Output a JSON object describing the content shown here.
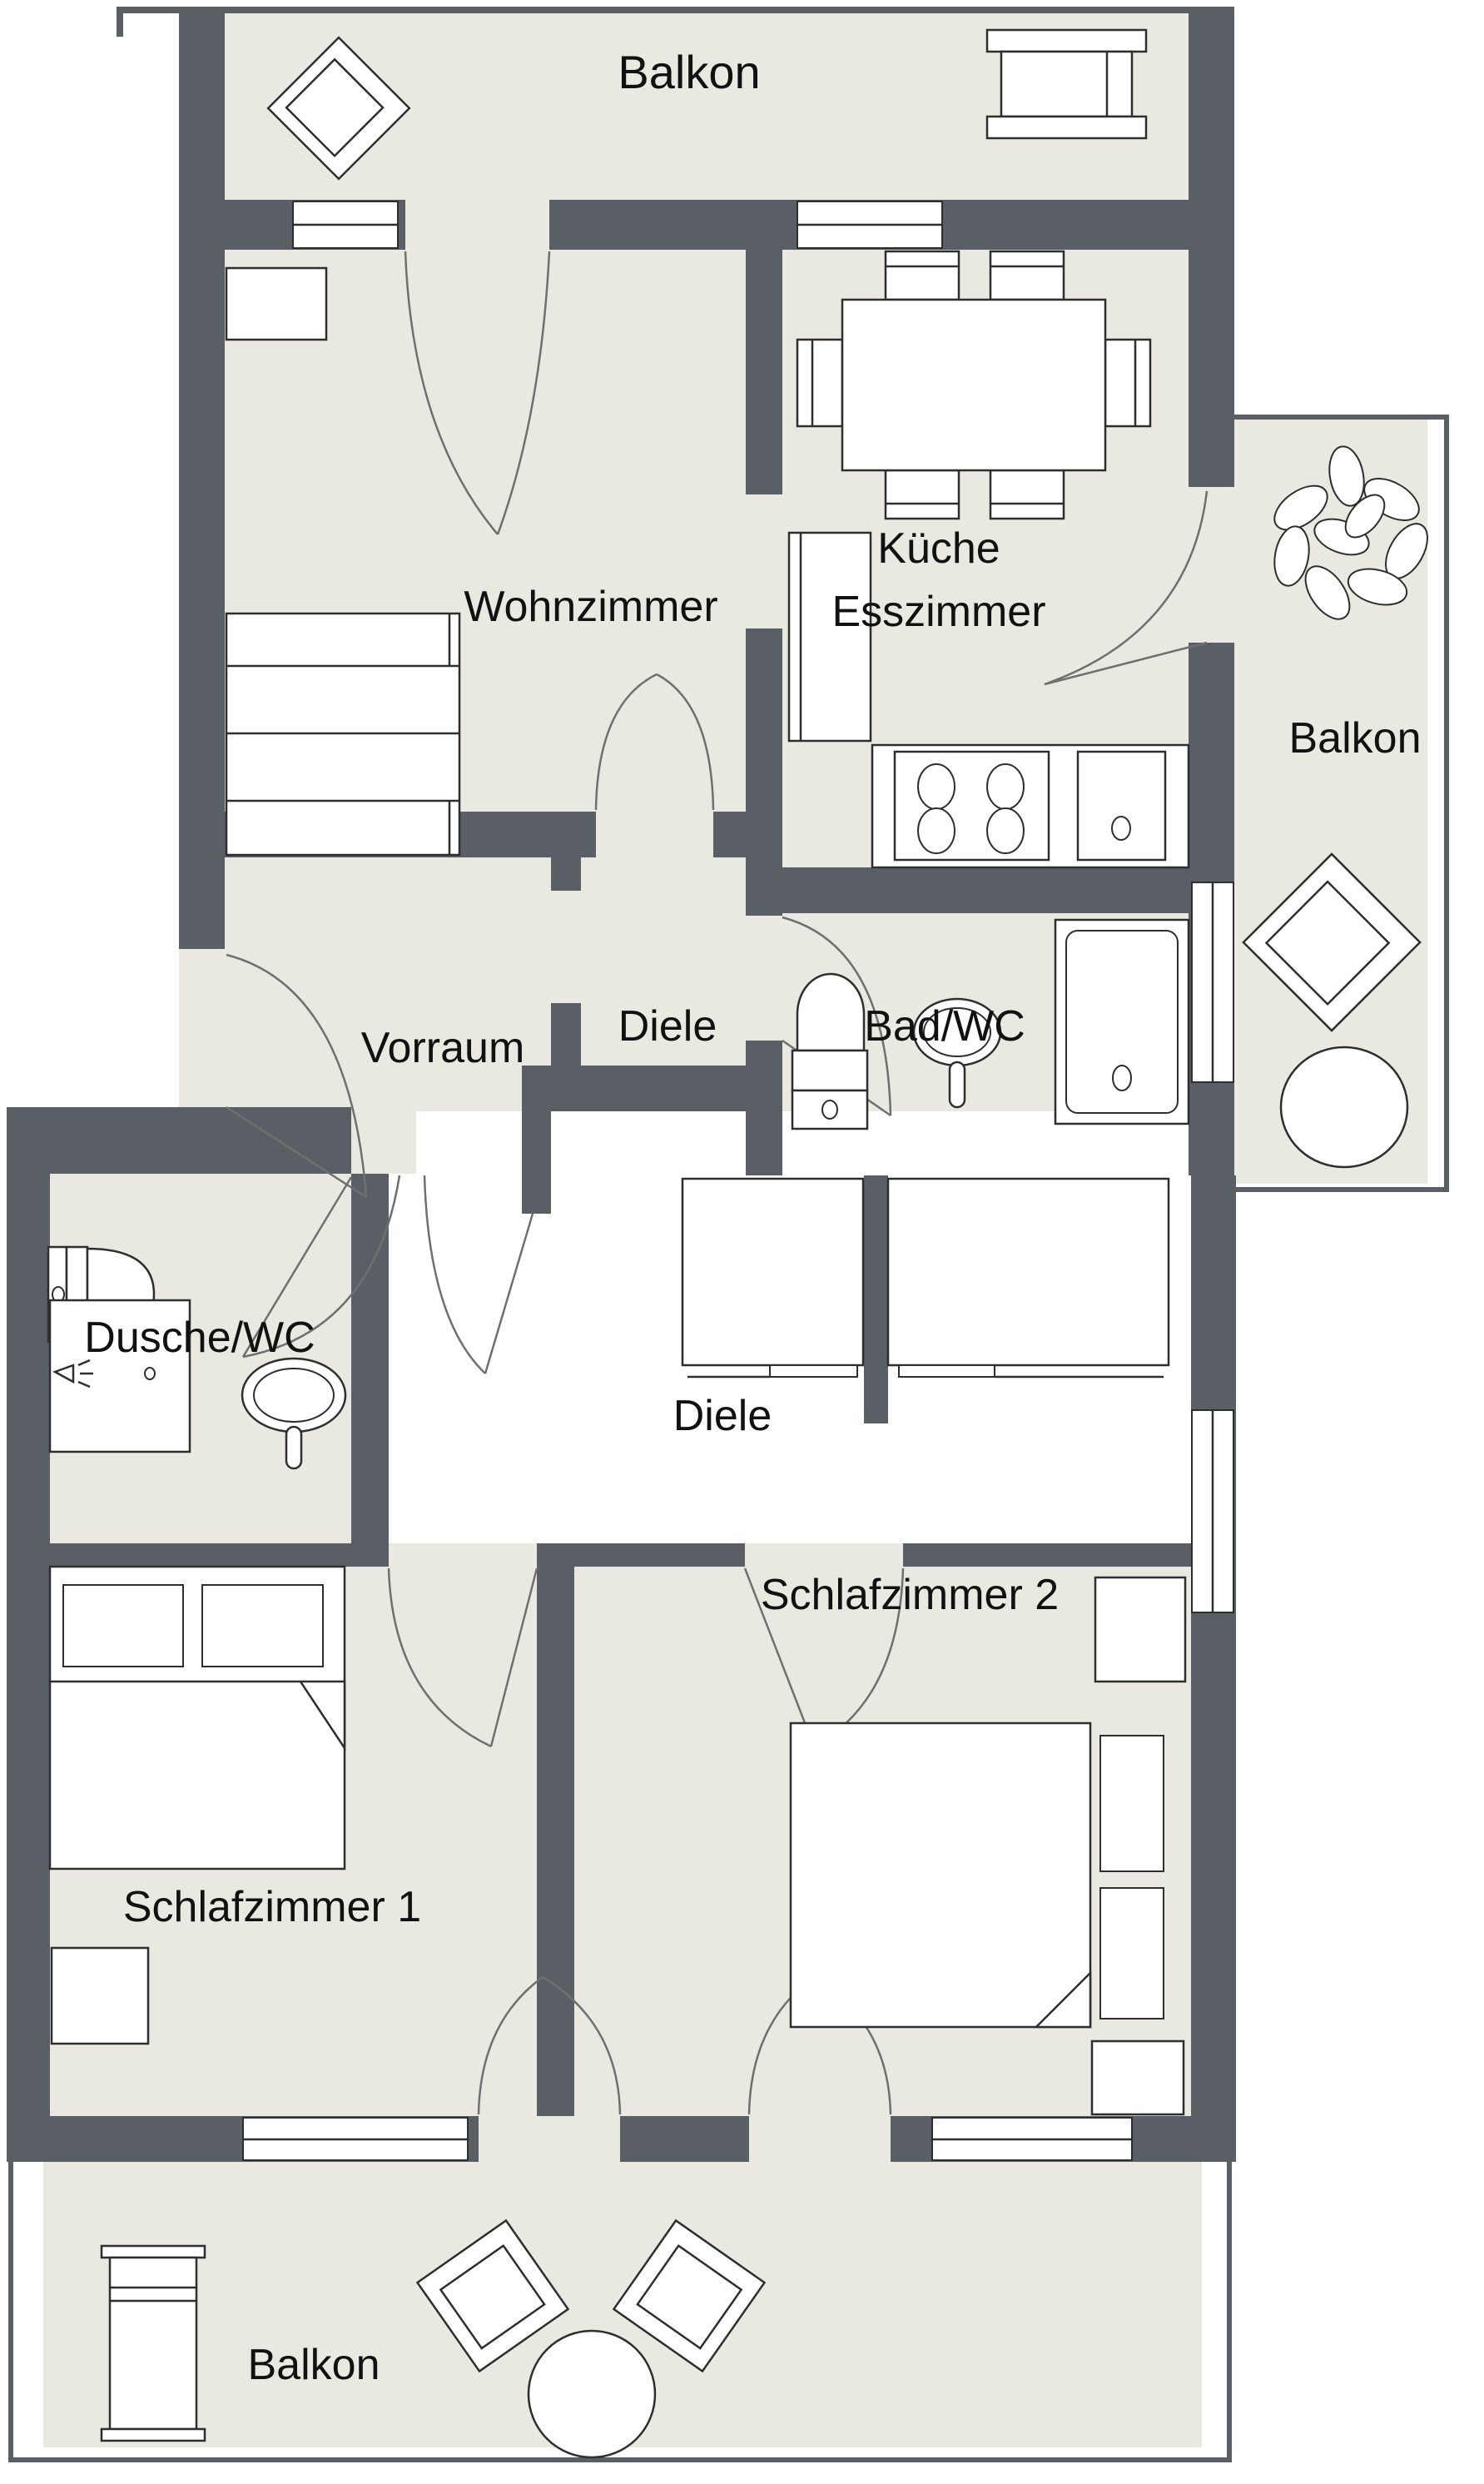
{
  "title": "Apartment floor plan",
  "theme": {
    "wall_color": "#5a5f66",
    "floor_color": "#e9e9e1",
    "hall_floor_color": "#ffffff",
    "furniture_stroke": "#2e2e2e",
    "door_arc_color": "#6f6f6f",
    "label_color": "#111111",
    "background": "#ffffff"
  },
  "labels": {
    "balkon_top": "Balkon",
    "wohnzimmer": "Wohnzimmer",
    "kueche_line1": "Küche",
    "kueche_line2": "Esszimmer",
    "balkon_right": "Balkon",
    "vorraum": "Vorraum",
    "diele_upper": "Diele",
    "bad_wc": "Bad/WC",
    "dusche_wc": "Dusche/WC",
    "diele_lower": "Diele",
    "schlafzimmer_1": "Schlafzimmer 1",
    "schlafzimmer_2": "Schlafzimmer 2",
    "balkon_bottom": "Balkon"
  },
  "icons": [
    "armchair-icon",
    "side-table-icon",
    "sofa-icon",
    "cabinet-icon",
    "dining-table-icon",
    "chair-icon",
    "fridge-cabinet-icon",
    "stove-icon",
    "kitchen-sink-icon",
    "plant-icon",
    "round-table-icon",
    "bathtub-icon",
    "toilet-icon",
    "washbasin-icon",
    "shower-icon",
    "wardrobe-icon",
    "double-bed-icon",
    "nightstand-icon",
    "sun-lounger-icon",
    "window-icon",
    "door-arc-icon"
  ]
}
